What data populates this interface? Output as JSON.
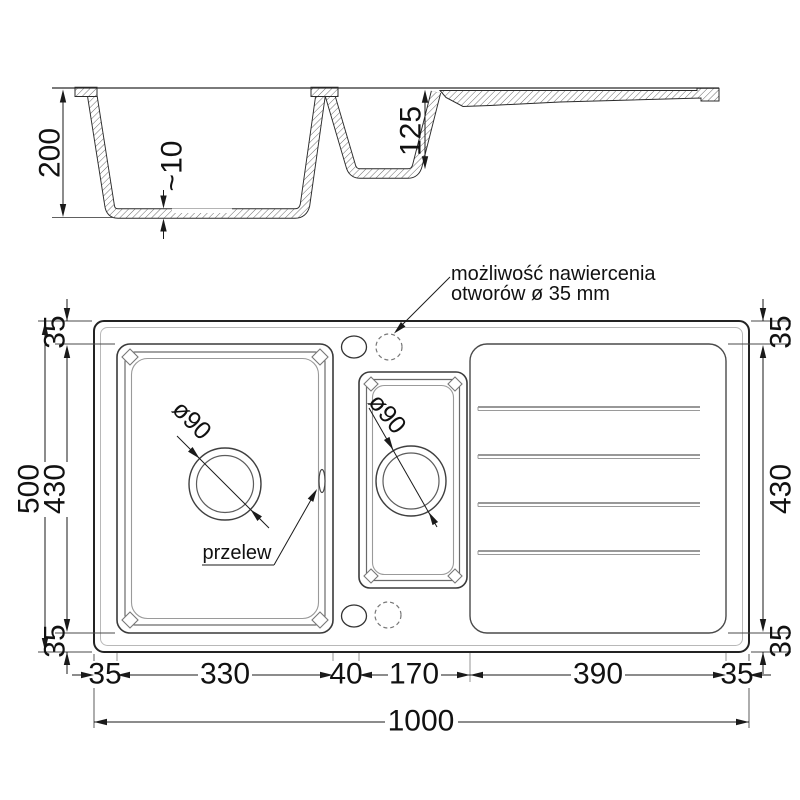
{
  "drawing": {
    "section_view": {
      "depth_total": "200",
      "bottom_thickness": "~10",
      "small_bowl_depth": "125"
    },
    "plan_view": {
      "note": {
        "line1": "możliwość nawiercenia",
        "line2": "otworów ø 35 mm"
      },
      "overflow_label": "przelew",
      "main_drain_label": "ø90",
      "small_drain_label": "ø90",
      "left_dims": {
        "total": "500",
        "top": "35",
        "middle": "430",
        "bottom": "35"
      },
      "right_dims": {
        "top": "35",
        "middle": "430",
        "bottom": "35"
      },
      "bottom_dims": {
        "seg1": "35",
        "seg2": "330",
        "seg3": "40",
        "seg4": "170",
        "seg5": "390",
        "seg6": "35",
        "total": "1000"
      }
    }
  }
}
